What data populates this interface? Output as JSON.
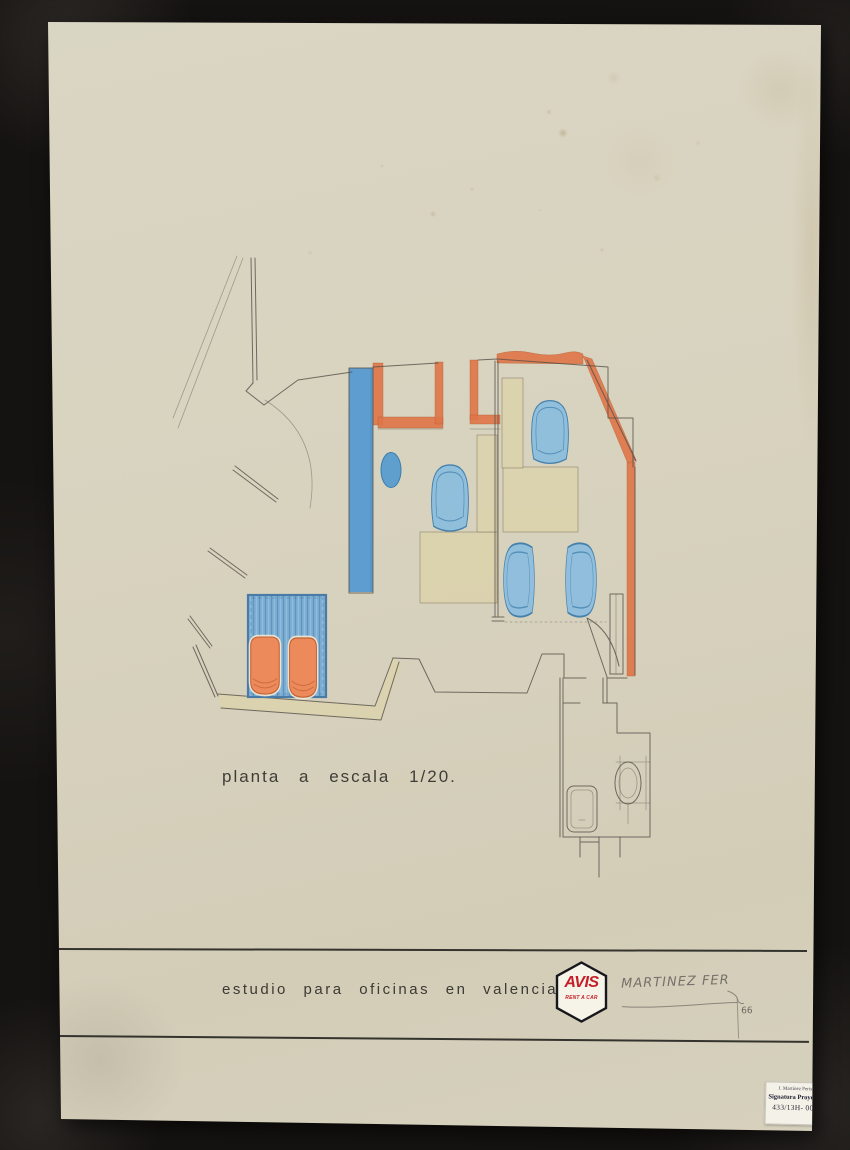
{
  "drawing": {
    "plan_label": "planta a escala 1/20.",
    "caption": "estudio para oficinas en valencia de",
    "logo": {
      "name": "AVIS",
      "subtitle": "RENT A CAR"
    },
    "signature": {
      "name": "MARTINEZ FER",
      "year": "66"
    },
    "archive_label": {
      "line1": "J. Martínez Peris",
      "line2": "Signatura Proyecto",
      "line3": "433/13H- 002"
    },
    "colors": {
      "background": "#151311",
      "board": "#d8d3bf",
      "wall_orange": "#e0764a",
      "wall_blue": "#5d9dcf",
      "furniture_blue": "#8dbede",
      "chair_orange": "#ec8a5c",
      "desk_beige": "#dcd2ae",
      "pencil": "#57524a",
      "avis_red": "#c41e28"
    }
  }
}
